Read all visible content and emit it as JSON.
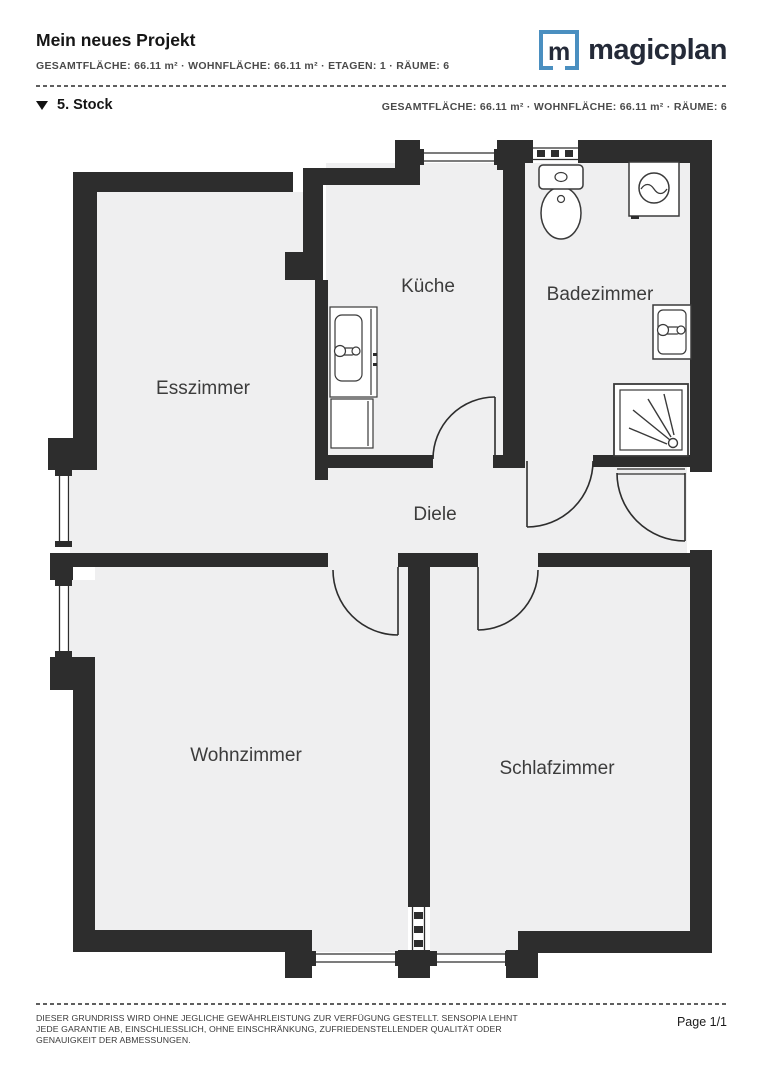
{
  "header": {
    "title": "Mein neues Projekt",
    "stats": "GESAMTFLÄCHE: 66.11 m² · WOHNFLÄCHE: 66.11 m² · ETAGEN: 1 · RÄUME: 6",
    "logo_letter": "m",
    "logo_text": "magicplan"
  },
  "section": {
    "name": "5. Stock",
    "stats": "GESAMTFLÄCHE: 66.11 m² · WOHNFLÄCHE: 66.11 m² · RÄUME: 6"
  },
  "rooms": [
    {
      "label": "Esszimmer"
    },
    {
      "label": "Küche"
    },
    {
      "label": "Badezimmer"
    },
    {
      "label": "Diele"
    },
    {
      "label": "Wohnzimmer"
    },
    {
      "label": "Schlafzimmer"
    }
  ],
  "fixtures": [
    "toilet",
    "washing-machine",
    "bathroom-sink",
    "shower",
    "kitchen-sink"
  ],
  "footer": {
    "disclaimer": "DIESER GRUNDRISS WIRD OHNE JEGLICHE GEWÄHRLEISTUNG ZUR VERFÜGUNG GESTELLT. SENSOPIA LEHNT JEDE GARANTIE AB, EINSCHLIESSLICH, OHNE EINSCHRÄNKUNG, ZUFRIEDENSTELLENDER QUALITÄT ODER GENAUIGKEIT DER ABMESSUNGEN.",
    "page": "Page 1/1"
  },
  "colors": {
    "wall": "#2d2d2d",
    "room_fill": "#efeff0",
    "logo_blue": "#4a8fc0",
    "logo_dark": "#242a38",
    "label_text": "#3c3c3c"
  }
}
